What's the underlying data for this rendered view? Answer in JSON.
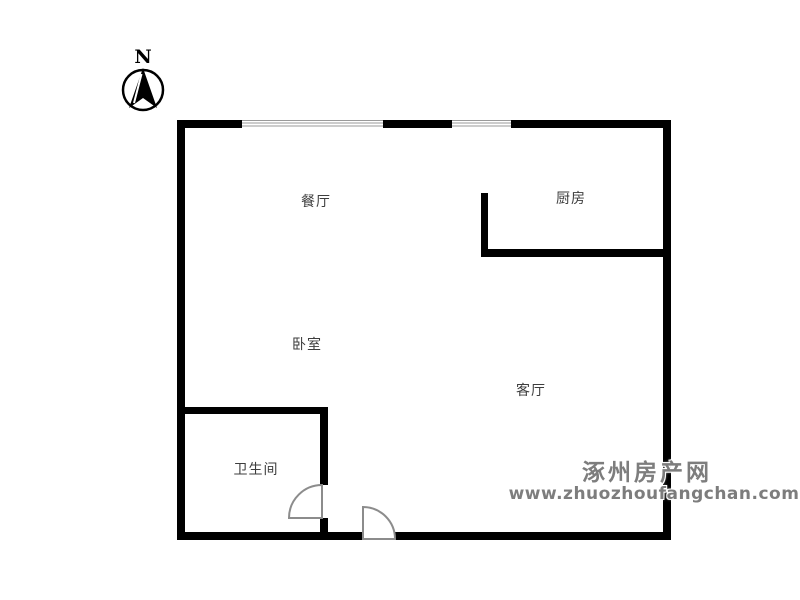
{
  "page": {
    "type": "real-estate floor plan",
    "background": "#ffffff"
  },
  "compass": {
    "label": "N"
  },
  "rooms": [
    {
      "id": "dining-room",
      "label": "餐厅"
    },
    {
      "id": "kitchen",
      "label": "厨房"
    },
    {
      "id": "bedroom",
      "label": "卧室"
    },
    {
      "id": "living-room",
      "label": "客厅"
    },
    {
      "id": "bathroom",
      "label": "卫生间"
    }
  ],
  "watermark": {
    "site_name": "涿州房产网",
    "site_url": "www.zhuozhoufangchan.com"
  },
  "colors": {
    "wall": "#000000",
    "window_line": "#9a9a9a",
    "door_stroke": "#8c8c8c",
    "room_label": "#3d3d3d",
    "watermark": "#7d7d7d"
  }
}
